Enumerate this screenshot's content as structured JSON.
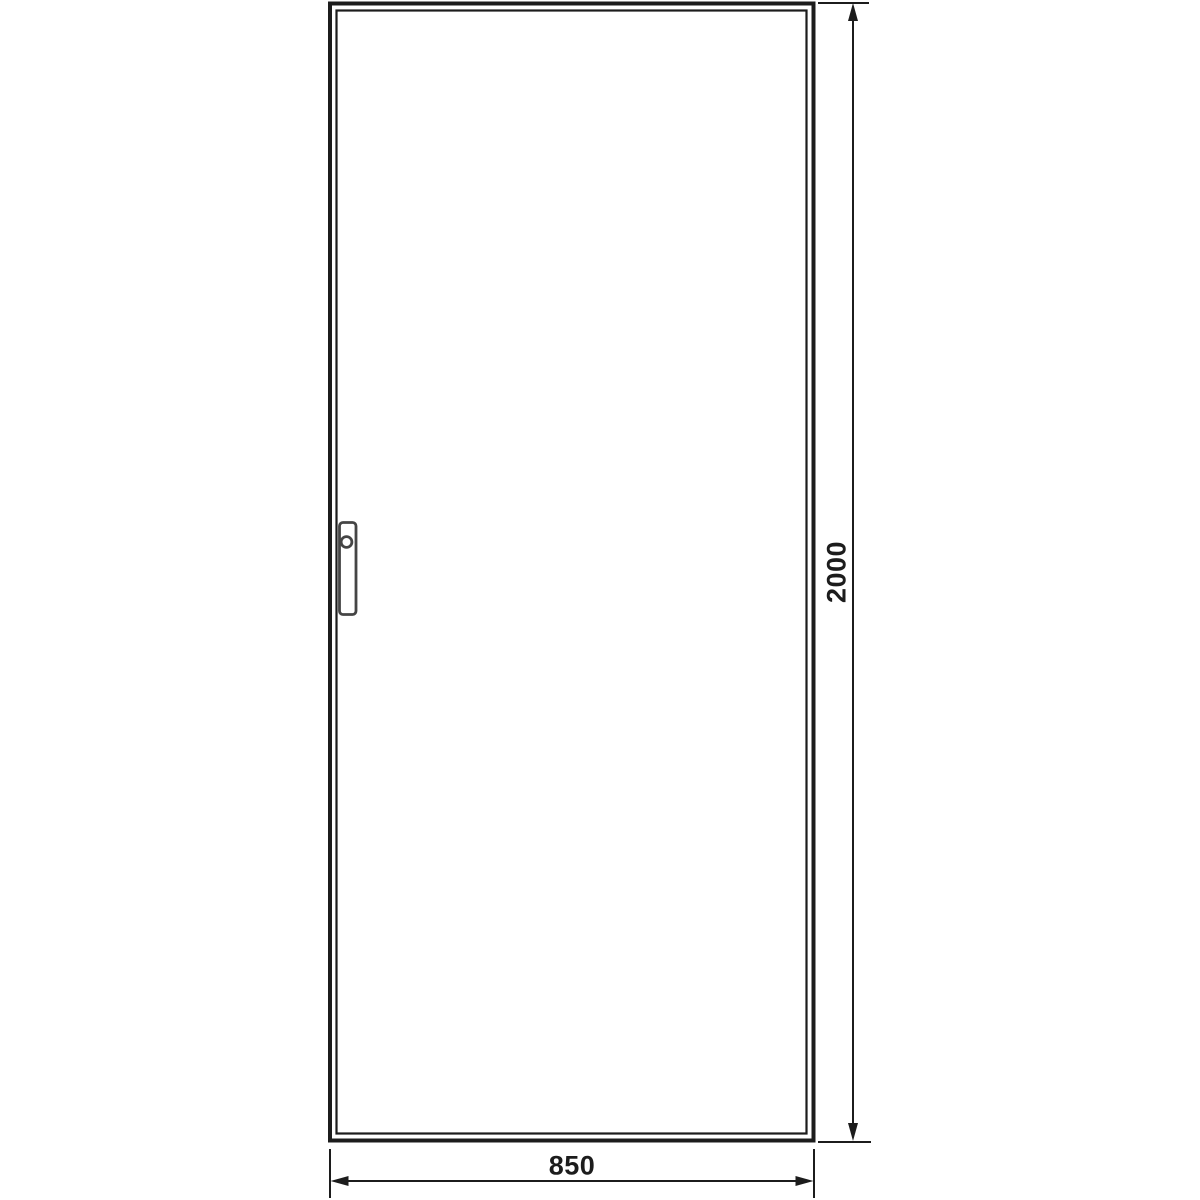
{
  "drawing": {
    "name": "door-front-view-technical-drawing",
    "colors": {
      "background": "#ffffff",
      "line": "#1c1c1c",
      "handle": "#454545"
    },
    "dimensions": {
      "height": {
        "value": "2000"
      },
      "width": {
        "value": "850"
      }
    }
  }
}
